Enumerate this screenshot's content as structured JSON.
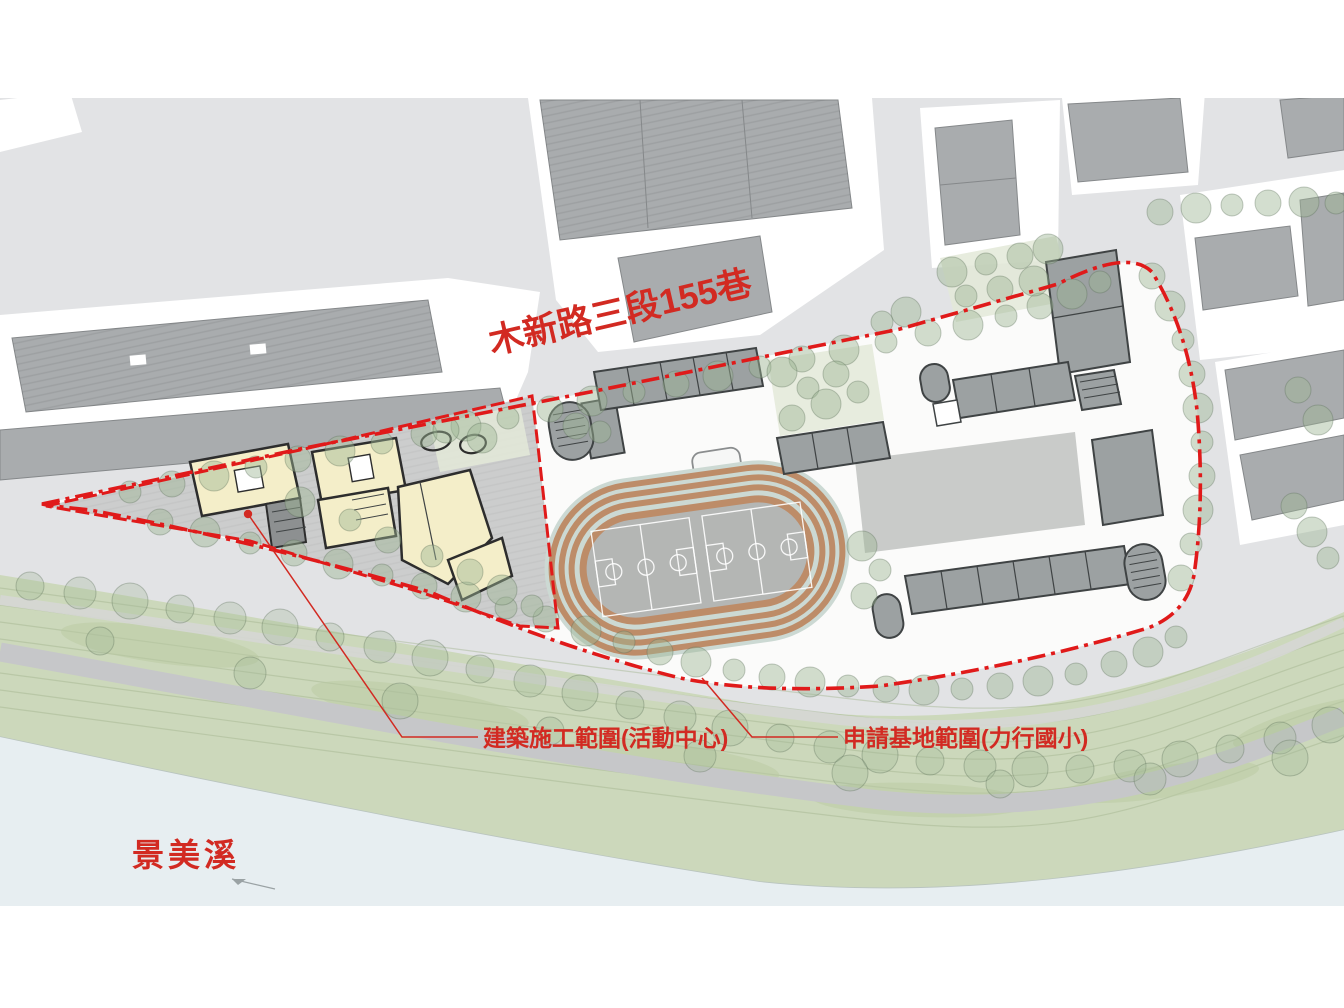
{
  "title": "力行國小校園活動中心 基地配置圖",
  "labels": {
    "road_name": "木新路三段155巷",
    "construction_scope": "建築施工範圍(活動中心)",
    "site_scope": "申請基地範圍(力行國小)",
    "river_name": "景美溪"
  },
  "map": {
    "type": "site-plan",
    "features": [
      "urban blocks with gray buildings (north)",
      "red dash-dot application site boundary around elementary school",
      "red construction zone boundary around activity center with cream buildings",
      "running track with basketball courts",
      "gray classroom rows with stair towers",
      "street tree rows along roads",
      "green riverbank with paths and trees",
      "river at south-west"
    ]
  },
  "colors": {
    "label_red": "#d22a22",
    "boundary_red": "#e01a1a",
    "street_gray": "#e2e3e5",
    "building_gray": "#a9acae",
    "school_building_gray": "#9ca1a2",
    "cream_building": "#f4eec9",
    "plaza_gray": "#cccdcd",
    "track_lane_terracotta": "#bd8c68",
    "track_lane_light": "#ccd9d3",
    "court_gray": "#b4b6b4",
    "tree_green": "#9eb694",
    "bank_green": "#ccd8bb",
    "river_blue": "#e7eef1",
    "path_gray": "#c6c7c9"
  }
}
